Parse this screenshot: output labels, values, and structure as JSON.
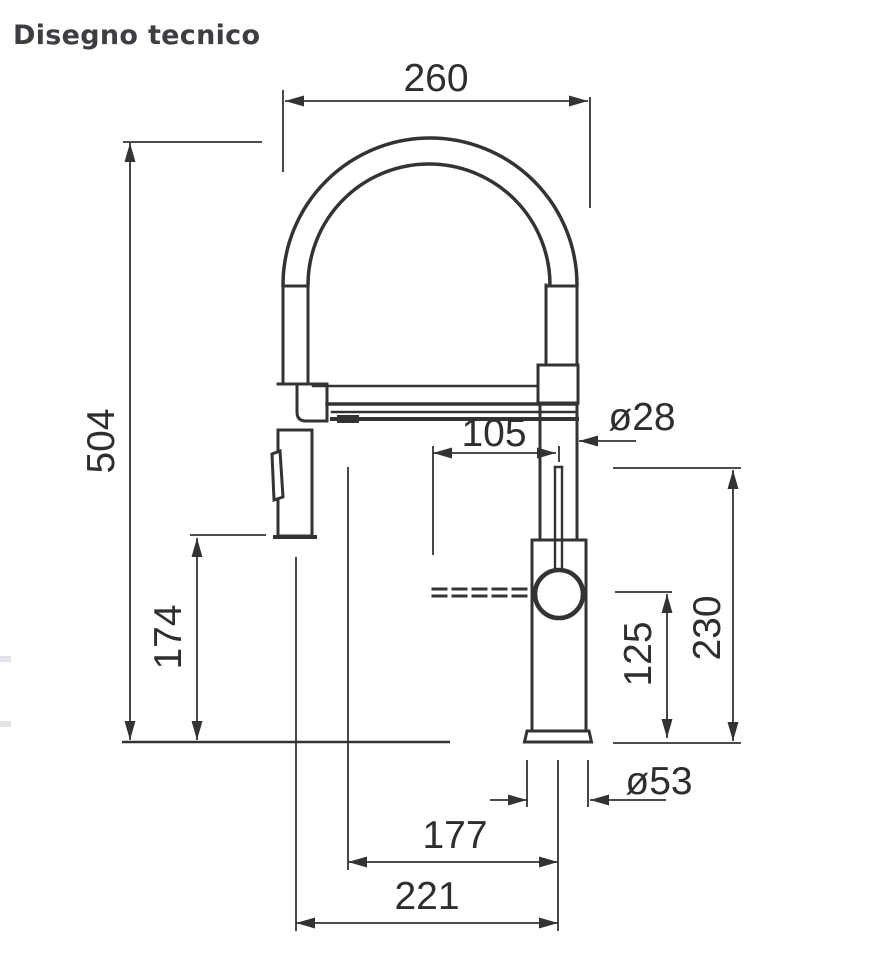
{
  "page": {
    "title": "Disegno tecnico"
  },
  "drawing": {
    "type": "technical-drawing",
    "subject": "kitchen faucet with pull-out spray, front elevation",
    "units": "mm",
    "colors": {
      "line": "#333333",
      "title": "#3d3d42",
      "edge_mark": "#e2e4e8",
      "background": "#ffffff"
    },
    "dimensions": {
      "arch_width": "260",
      "total_height": "504",
      "outlet_to_axis": "105",
      "pipe_diameter": "ø28",
      "head_to_counter": "174",
      "lever_top_height": "230",
      "handle_center_height": "125",
      "base_diameter": "ø53",
      "outlet_reach": "177",
      "head_axis_reach": "221"
    }
  }
}
